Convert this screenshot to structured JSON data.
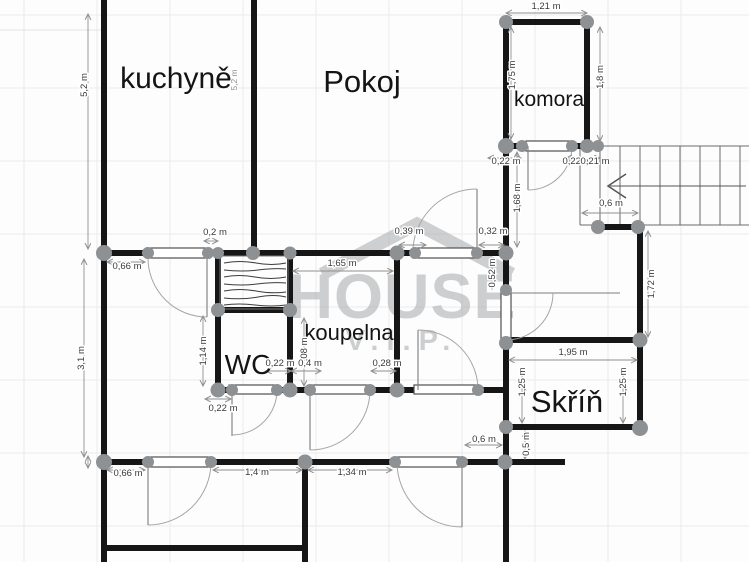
{
  "watermark": {
    "title": "HOUSE",
    "subtitle": "V.I.P."
  },
  "rooms": {
    "kuchyne": "kuchyně",
    "pokoj": "Pokoj",
    "komora": "komora",
    "koupelna": "koupelna",
    "wc": "WC",
    "skrin": "Skříň"
  },
  "dimensions": [
    "5,2 m",
    "5,2 m",
    "1,21 m",
    "1,75 m",
    "1,8 m",
    "0,22 m",
    "0,22 m",
    "0,21 m",
    "1,68 m",
    "0,6 m",
    "0,52 m",
    "1,72 m",
    "0,2 m",
    "0,39 m",
    "0,32 m",
    "1,65 m",
    "0,66 m",
    "3,1 m",
    "1,14 m",
    "1,08 m",
    "0,22 m",
    "0,4 m",
    "0,28 m",
    "0,22 m",
    "1,95 m",
    "1,25 m",
    "1,25 m",
    "0,6 m",
    "0,5 m",
    "0,66 m",
    "1,4 m",
    "1,34 m"
  ]
}
